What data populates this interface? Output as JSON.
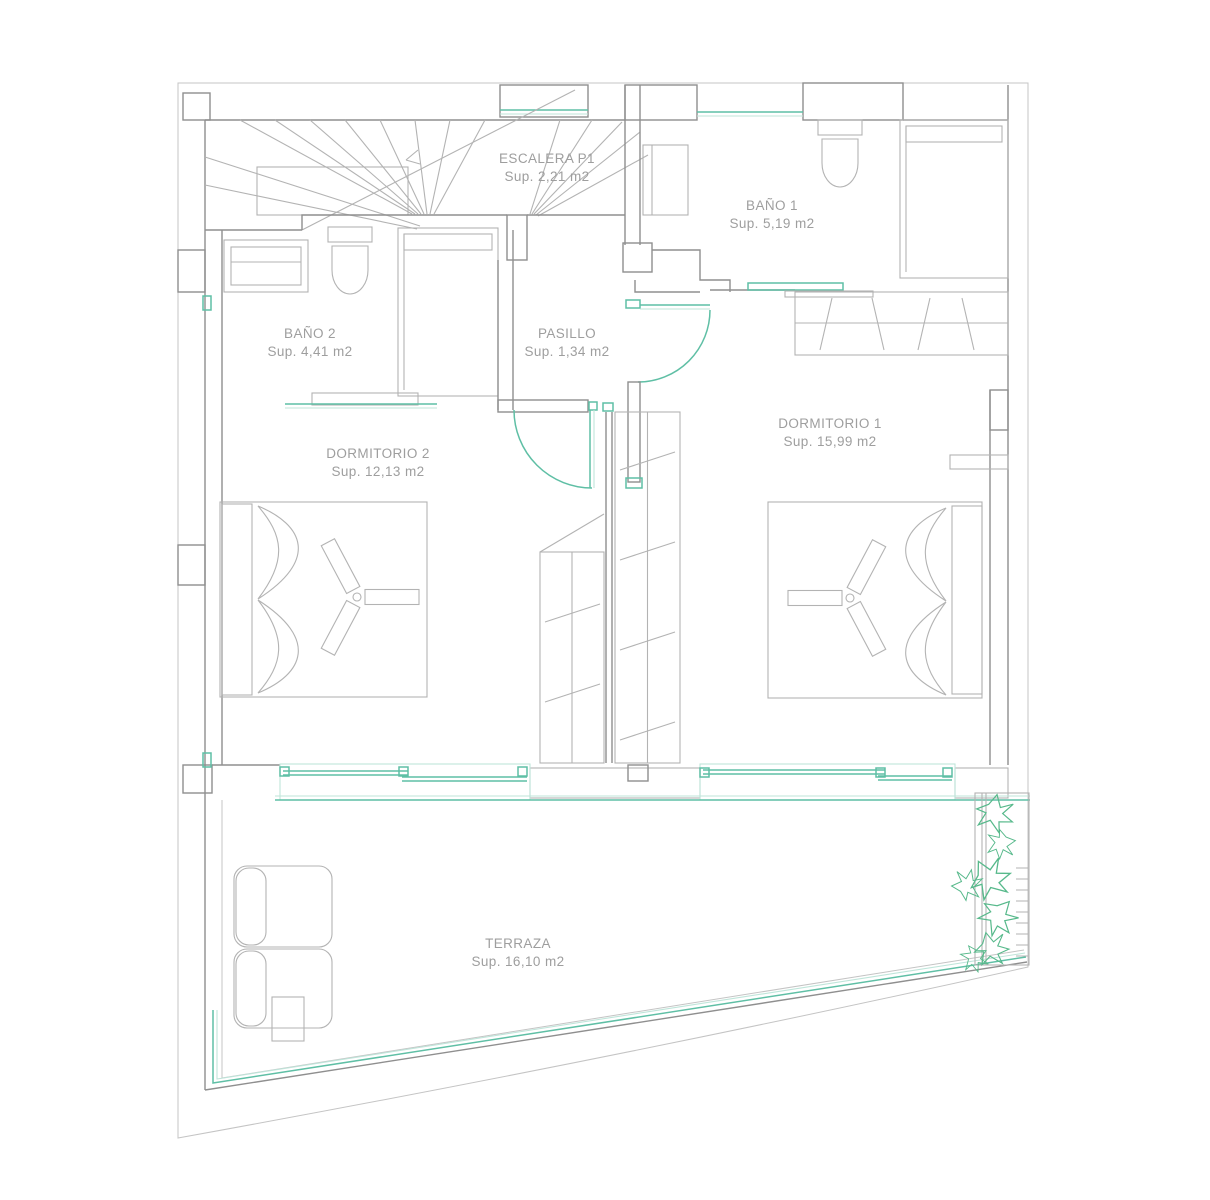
{
  "plan": {
    "title": "Floor plan P1",
    "rooms": [
      {
        "id": "escalera",
        "label": "ESCALERA P1",
        "area": "Sup. 2,21 m2"
      },
      {
        "id": "bano1",
        "label": "BAÑO 1",
        "area": "Sup. 5,19 m2"
      },
      {
        "id": "bano2",
        "label": "BAÑO 2",
        "area": "Sup. 4,41 m2"
      },
      {
        "id": "pasillo",
        "label": "PASILLO",
        "area": "Sup. 1,34 m2"
      },
      {
        "id": "dormitorio1",
        "label": "DORMITORIO 1",
        "area": "Sup. 15,99 m2"
      },
      {
        "id": "dormitorio2",
        "label": "DORMITORIO 2",
        "area": "Sup. 12,13 m2"
      },
      {
        "id": "terraza",
        "label": "TERRAZA",
        "area": "Sup. 16,10 m2"
      }
    ],
    "colors": {
      "wall": "#8f8f8f",
      "light": "#c4c4c4",
      "fixture": "#b3b3b3",
      "accent": "#5fbfa5",
      "accent_light": "#bfe5da",
      "plant": "#57b98b",
      "text": "#9e9e9e"
    }
  }
}
